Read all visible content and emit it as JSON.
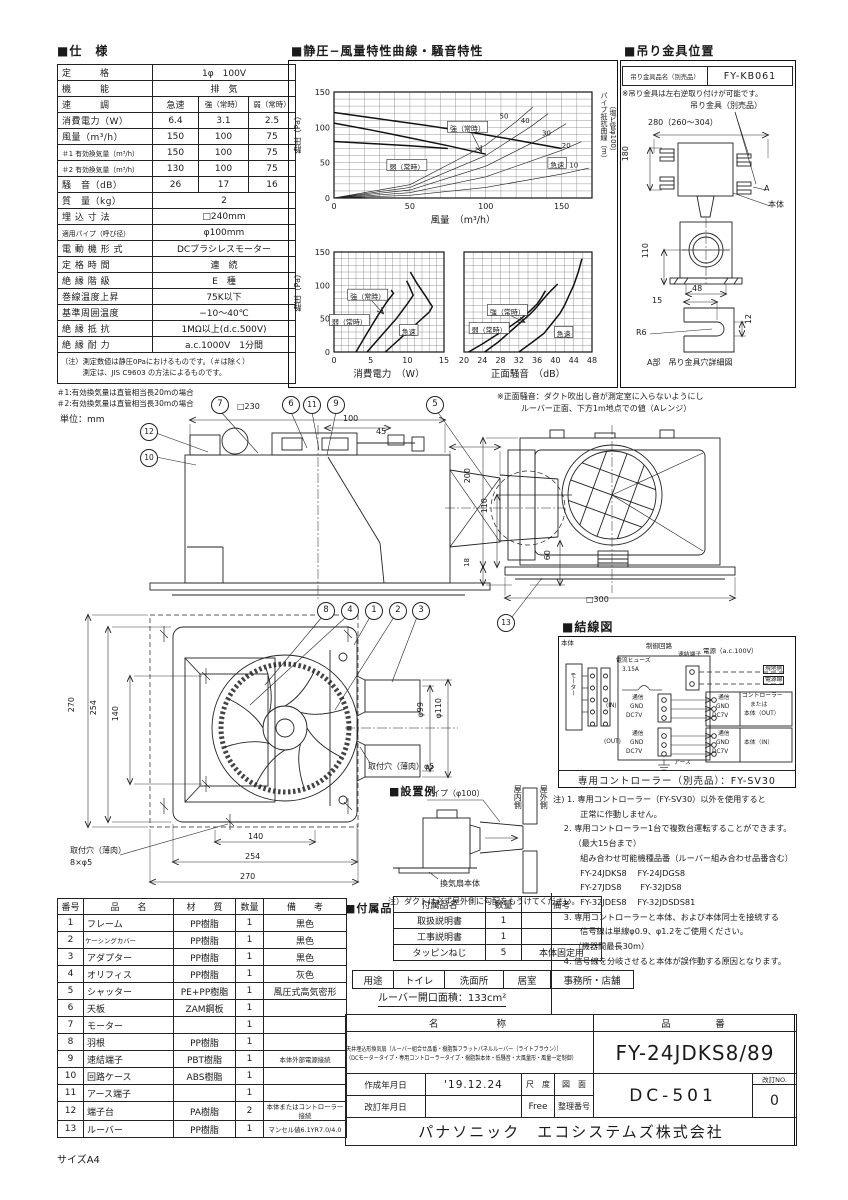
{
  "titles": {
    "spec": "■仕　様",
    "charts": "■静圧−風量特性曲線・騒音特性",
    "bracket": "■吊り金具位置",
    "wiring": "■結線図",
    "install": "■設置例",
    "accessories": "■付属品"
  },
  "spec": {
    "rows": [
      {
        "label": "定　　　格",
        "value": "1φ　100V"
      },
      {
        "label": "機　　　能",
        "value": "排　気"
      },
      {
        "label": "速　　　調",
        "values": [
          "急速",
          "強（常時）",
          "弱（常時）"
        ]
      },
      {
        "label": "消費電力（W）",
        "values": [
          "6.4",
          "3.1",
          "2.5"
        ]
      },
      {
        "label": "風量（m³/h）",
        "values": [
          "150",
          "100",
          "75"
        ]
      },
      {
        "label": "＃1 有効換気量（m³/h）",
        "values": [
          "150",
          "100",
          "75"
        ],
        "small": true
      },
      {
        "label": "＃2 有効換気量（m³/h）",
        "values": [
          "130",
          "100",
          "75"
        ],
        "small": true
      },
      {
        "label": "騒　音（dB）",
        "values": [
          "26",
          "17",
          "16"
        ]
      },
      {
        "label": "質　量（kg）",
        "value": "2"
      },
      {
        "label": "埋 込 寸 法",
        "value": "□240mm"
      },
      {
        "label": "適用パイプ（呼び径）",
        "value": "φ100mm",
        "small": true
      },
      {
        "label": "電 動 機 形 式",
        "value": "DCブラシレスモーター"
      },
      {
        "label": "定 格 時 間",
        "value": "連　続"
      },
      {
        "label": "絶 縁 階 級",
        "value": "E　種"
      },
      {
        "label": "巻線温度上昇",
        "value": "75K以下"
      },
      {
        "label": "基準周囲温度",
        "value": "−10～40℃"
      },
      {
        "label": "絶 縁 抵 抗",
        "value": "1MΩ以上(d.c.500V)"
      },
      {
        "label": "絶 縁 耐 力",
        "value": "a.c.1000V　1分間"
      }
    ],
    "notes": [
      "（注）測定数値は静圧0Paにおけるものです。（＃は除く）",
      "　　　測定は、JIS C9603 の方法によるものです。"
    ],
    "footnotes": [
      "＃1:有効換気量は直管相当長20mの場合",
      "＃2:有効換気量は直管相当長30mの場合"
    ],
    "unit_note": "単位：mm"
  },
  "chart_data": [
    {
      "type": "line",
      "title": "静圧−風量特性曲線",
      "xlabel": "風量　（m³/h）",
      "ylabel": "静圧（Pa）",
      "right_label": [
        "パイプ抵抗曲線（m）",
        "（塩ビ管φ100）"
      ],
      "xlim": [
        0,
        170
      ],
      "ylim": [
        0,
        150
      ],
      "xticks": [
        0,
        50,
        100,
        150
      ],
      "yticks": [
        0,
        50,
        100,
        150
      ],
      "grid_step": {
        "x": 10,
        "y": 10
      },
      "series": [
        {
          "name": "急速",
          "bold": true,
          "x": [
            0,
            30,
            60,
            90,
            120,
            150
          ],
          "y": [
            121,
            112,
            103,
            93,
            82,
            70
          ]
        },
        {
          "name": "強（常時）",
          "bold": true,
          "x": [
            0,
            25,
            50,
            75,
            100
          ],
          "y": [
            106,
            96,
            85,
            74,
            62
          ]
        },
        {
          "name": "弱（常時）",
          "bold": true,
          "x": [
            0,
            25,
            50,
            75
          ],
          "y": [
            80,
            77,
            74,
            70
          ]
        },
        {
          "name": "パイプ抵抗10m",
          "x": [
            0,
            50,
            100,
            150,
            168
          ],
          "y": [
            0,
            3.8,
            15,
            33.8,
            42.3
          ]
        },
        {
          "name": "パイプ抵抗20m",
          "x": [
            0,
            50,
            100,
            150,
            163
          ],
          "y": [
            0,
            7.5,
            30,
            67.5,
            79.7
          ]
        },
        {
          "name": "パイプ抵抗30m",
          "x": [
            0,
            50,
            100,
            140,
            153
          ],
          "y": [
            0,
            11.3,
            45,
            88.2,
            105.3
          ]
        },
        {
          "name": "パイプ抵抗40m",
          "x": [
            0,
            50,
            100,
            130,
            141
          ],
          "y": [
            0,
            15,
            60,
            101.4,
            119.3
          ]
        },
        {
          "name": "パイプ抵抗50m",
          "x": [
            0,
            50,
            100,
            120,
            131
          ],
          "y": [
            0,
            18.8,
            75,
            108,
            128.7
          ]
        }
      ],
      "labels": [
        {
          "text": "強（常時）",
          "x": 88,
          "y": 98,
          "boxed": true,
          "arrow": [
            97,
            66
          ]
        },
        {
          "text": "弱（常時）",
          "x": 48,
          "y": 44,
          "boxed": true
        },
        {
          "text": "急速",
          "x": 147,
          "y": 47,
          "boxed": true
        },
        {
          "text": "50",
          "x": 112,
          "y": 116
        },
        {
          "text": "40",
          "x": 126,
          "y": 110
        },
        {
          "text": "30",
          "x": 140,
          "y": 92
        },
        {
          "text": "20",
          "x": 153,
          "y": 74
        },
        {
          "text": "10",
          "x": 158,
          "y": 47
        }
      ]
    },
    {
      "type": "line",
      "title": "消費電力特性",
      "xlabel": "消費電力　（W）",
      "ylabel": "静圧（Pa）",
      "xlim": [
        0,
        15
      ],
      "ylim": [
        0,
        150
      ],
      "xticks": [
        0,
        5,
        10,
        15
      ],
      "yticks": [
        0,
        50,
        100,
        150
      ],
      "grid_step": {
        "x": 1,
        "y": 10
      },
      "series": [
        {
          "name": "弱（常時）",
          "bold": true,
          "x": [
            3,
            4.5,
            6,
            7.2,
            8.1,
            7.8
          ],
          "y": [
            0,
            28,
            55,
            75,
            88,
            93
          ]
        },
        {
          "name": "強（常時）",
          "bold": true,
          "x": [
            4.5,
            6.5,
            8.5,
            10,
            10.8,
            10.3,
            9.9
          ],
          "y": [
            0,
            25,
            50,
            72,
            85,
            98,
            107
          ]
        },
        {
          "name": "急速",
          "bold": true,
          "x": [
            7,
            9.5,
            11.5,
            13,
            13.4,
            12.6,
            11.3,
            10.4
          ],
          "y": [
            0,
            25,
            45,
            60,
            68,
            82,
            103,
            120
          ]
        }
      ],
      "labels": [
        {
          "text": "強（常時）",
          "x": 4.6,
          "y": 83,
          "boxed": true,
          "arrow": [
            6.7,
            58
          ]
        },
        {
          "text": "弱（常時）",
          "x": 2.1,
          "y": 45,
          "boxed": true
        },
        {
          "text": "急速",
          "x": 10.2,
          "y": 30,
          "boxed": true
        }
      ]
    },
    {
      "type": "line",
      "title": "騒音特性",
      "xlabel": "正面騒音　（dB）",
      "ylabel": "静圧（Pa）",
      "show_yticks": false,
      "xlim": [
        20,
        48
      ],
      "ylim": [
        0,
        150
      ],
      "xticks": [
        20,
        24,
        28,
        32,
        36,
        40,
        44,
        48
      ],
      "yticks": [
        0,
        50,
        100,
        150
      ],
      "grid_step": {
        "x": 2,
        "y": 10
      },
      "series": [
        {
          "name": "弱（常時）",
          "bold": true,
          "x": [
            21,
            24,
            27,
            30,
            32.5,
            34.5,
            36,
            37,
            37.8
          ],
          "y": [
            0,
            12,
            25,
            38,
            50,
            62,
            72,
            82,
            92
          ]
        },
        {
          "name": "強（常時）",
          "bold": true,
          "x": [
            24.5,
            27.5,
            30,
            32.5,
            34.5,
            36,
            36.8,
            37.8,
            39,
            40.5
          ],
          "y": [
            0,
            15,
            30,
            45,
            57,
            68,
            75,
            83,
            92,
            102
          ]
        },
        {
          "name": "急速",
          "bold": true,
          "x": [
            32,
            35,
            37.5,
            39.5,
            41,
            42,
            43,
            44,
            45,
            45.8
          ],
          "y": [
            0,
            15,
            28,
            45,
            58,
            70,
            85,
            100,
            120,
            140
          ]
        }
      ],
      "labels": [
        {
          "text": "強（常時）",
          "x": 29.5,
          "y": 60,
          "boxed": true,
          "arrow": [
            33.2,
            45
          ]
        },
        {
          "text": "弱（常時）",
          "x": 25.5,
          "y": 33,
          "boxed": true
        },
        {
          "text": "急速",
          "x": 41.8,
          "y": 27,
          "boxed": true
        }
      ]
    }
  ],
  "noise_note": [
    "※正面騒音：ダクト吹出し音が測定室に入らないようにし",
    "　　　ルーバー正面、下方1m地点での値（Aレンジ）"
  ],
  "bracket": {
    "table_label": "吊り金具品名（別売品）",
    "part_no": "FY-KB061",
    "note": "※吊り金具は左右逆取り付けが可能です。",
    "callout": "吊り金具（別売品）",
    "dims": {
      "w": "280（260～304）",
      "h": "180",
      "h2": "110",
      "w2": "48",
      "d15": "15",
      "d12": "12",
      "r": "R6"
    },
    "labels": {
      "a": "A",
      "body": "本体",
      "detail": "A部　吊り金具穴詳細図"
    }
  },
  "drawings": {
    "callouts": {
      "c1": "1",
      "c2": "2",
      "c3": "3",
      "c4": "4",
      "c5": "5",
      "c6": "6",
      "c7": "7",
      "c8": "8",
      "c9": "9",
      "c10": "10",
      "c11": "11",
      "c12": "12",
      "c13": "13"
    },
    "side": {
      "d230": "□230",
      "d100": "100",
      "d45": "45",
      "d60": "60"
    },
    "rear": {
      "d200": "200",
      "d110": "110",
      "d18": "18",
      "d300": "□300"
    },
    "front": {
      "v270": "270",
      "v254": "254",
      "v140": "140",
      "h140": "140",
      "h254": "254",
      "h270": "270",
      "p99": "φ99",
      "p110": "φ110",
      "hole_l1": "取付穴（薄肉）",
      "hole_l2": "8×φ5",
      "hole_r": "取付穴（薄肉）φ5"
    }
  },
  "install": {
    "pipe": "パイプ（φ100）",
    "inside": "屋内側",
    "outside": "屋外側",
    "body": "換気扇本体",
    "note": "注）ダクトは必ず屋外側に勾配をもうけてください。"
  },
  "wiring": {
    "labels": {
      "body": "本体",
      "motor": "モーター",
      "circuit": "制御回路",
      "fuse1": "電流ヒューズ",
      "fuse2": "3.15A",
      "terminal": "速結端子",
      "power": "電源（a.c.100V）",
      "site1": "現地側",
      "site2": "電源線",
      "in": "(IN)",
      "out": "(OUT)",
      "com": "通信",
      "gnd": "GND",
      "dc": "DC7V",
      "ctl1": "コントローラー",
      "ctl2": "または",
      "ctl3": "本体（OUT）",
      "right_in": "本体（IN）",
      "earth": "アース"
    },
    "controller": "専用コントローラー（別売品）：FY-SV30"
  },
  "wiring_notes": [
    "注) 1. 専用コントローラー（FY-SV30）以外を使用すると",
    "　　　 正常に作動しません。",
    "　 2. 専用コントローラー1台で複数台運転することができます。",
    "　　　（最大15台まで）",
    "　　　 組み合わせ可能機種品番（ルーバー組み合わせ品番含む）",
    "　　　 FY-24JDKS8　 FY-24JDGS8",
    "　　　 FY-27JDS8　　 FY-32JDS8",
    "　　　 FY-32JDES8　 FY-32JDSDS81",
    "　 3. 専用コントローラーと本体、および本体同士を接続する",
    "　　　 信号線は単線φ0.9、φ1.2をご使用ください。",
    "　　　（機器間最長30m）",
    "　 4. 信号線を分岐させると本体が誤作動する原因となります。"
  ],
  "parts": {
    "headers": [
      "番号",
      "品　　名",
      "材　　質",
      "数量",
      "備　　考"
    ],
    "rows": [
      [
        "1",
        "フレーム",
        "PP樹脂",
        "1",
        "黒色"
      ],
      [
        "2",
        "ケーシングカバー",
        "PP樹脂",
        "1",
        "黒色"
      ],
      [
        "3",
        "アダプター",
        "PP樹脂",
        "1",
        "黒色"
      ],
      [
        "4",
        "オリフィス",
        "PP樹脂",
        "1",
        "灰色"
      ],
      [
        "5",
        "シャッター",
        "PE+PP樹脂",
        "1",
        "風圧式高気密形"
      ],
      [
        "6",
        "天板",
        "ZAM鋼板",
        "1",
        ""
      ],
      [
        "7",
        "モーター",
        "",
        "1",
        ""
      ],
      [
        "8",
        "羽根",
        "PP樹脂",
        "1",
        ""
      ],
      [
        "9",
        "速結端子",
        "PBT樹脂",
        "1",
        "本体外部電源接続"
      ],
      [
        "10",
        "回路ケース",
        "ABS樹脂",
        "1",
        ""
      ],
      [
        "11",
        "アース端子",
        "",
        "1",
        ""
      ],
      [
        "12",
        "端子台",
        "PA樹脂",
        "2",
        "本体またはコントローラー接続"
      ],
      [
        "13",
        "ルーバー",
        "PP樹脂",
        "1",
        "マンセル値6.1YR7.0/4.0"
      ]
    ]
  },
  "accessories": {
    "headers": [
      "付属品名",
      "数量",
      "備考"
    ],
    "rows": [
      [
        "取扱説明書",
        "1",
        ""
      ],
      [
        "工事説明書",
        "1",
        ""
      ],
      [
        "タッピンねじ",
        "5",
        "本体固定用"
      ]
    ]
  },
  "usage": {
    "label": "用途",
    "items": [
      "トイレ",
      "洗面所",
      "居室",
      "事務所・店舗"
    ]
  },
  "louver_area": "ルーバー開口面積：133cm²",
  "title_block": {
    "name_header": "名　　　　称",
    "pn_header": "品　　　番",
    "name_line1": "天井埋込形換気扇（ルーバー組合せ品番・樹脂製フラットパネルルーバー（ライトブラウン））",
    "name_line2": "（DCモータータイプ・専用コントローラータイプ・樹脂製本体・低騒音・大風量形・風量一定制御）",
    "part_number": "FY-24JDKS8/89",
    "created_label": "作成年月日",
    "created": "'19.12.24",
    "revised_label": "改訂年月日",
    "revised": "",
    "scale_label": "尺　度",
    "scale": "Free",
    "dwg_label1": "図　面",
    "dwg_label2": "整理番号",
    "dwg_no": "DC-501",
    "rev_label": "改訂NO.",
    "rev_no": "0",
    "company": "パナソニック　エコシステムズ株式会社"
  },
  "page": {
    "size": "サイズA4"
  }
}
